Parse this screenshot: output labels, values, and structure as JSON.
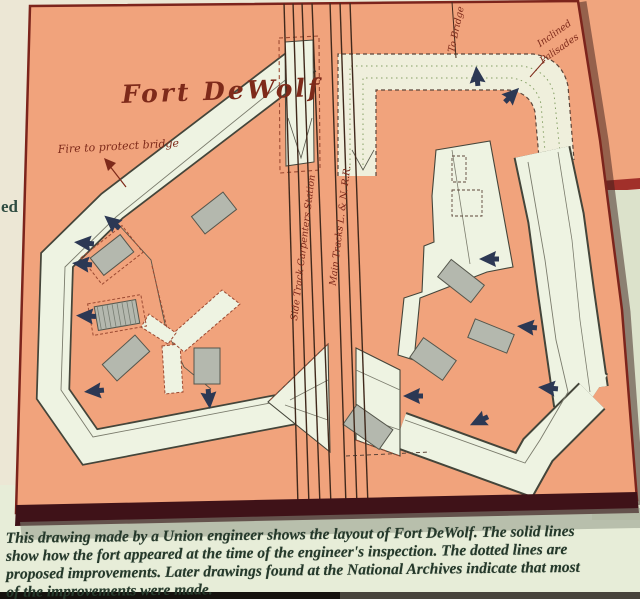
{
  "map_labels": {
    "title": "Fort DeWolf",
    "fire_note": "Fire to protect bridge",
    "to_bridge": "To Bridge",
    "inclined_line1": "Inclined",
    "inclined_line2": "Palisades",
    "side_track": "Side Track Carpenters Station",
    "main_track": "Main Tracks L. & N. R.R."
  },
  "caption": {
    "lines": [
      "This drawing made by a Union engineer shows the layout of Fort DeWolf. The solid lines",
      "show how the fort appeared at the time of the engineer's inspection. The dotted lines are",
      "proposed improvements. Later drawings found at the National Archives indicate that most",
      "of the improvements were made."
    ]
  },
  "edge_fragment": "ed",
  "colors": {
    "map_background": "#f1a37c",
    "rampart_fill": "#eef3e2",
    "rampart_outline": "#44453a",
    "cannon": "#2c3854",
    "building": "#b4b8ae",
    "proposed_dashed": "#9c4a32",
    "map_border": "#7c241c",
    "caption_text": "#25392b",
    "caption_background": "#e7edd8",
    "track_line": "#40291c",
    "label_red": "#7e2a1a",
    "side_panel_sage": "#dce2cb",
    "side_panel_red": "#a1302a"
  }
}
